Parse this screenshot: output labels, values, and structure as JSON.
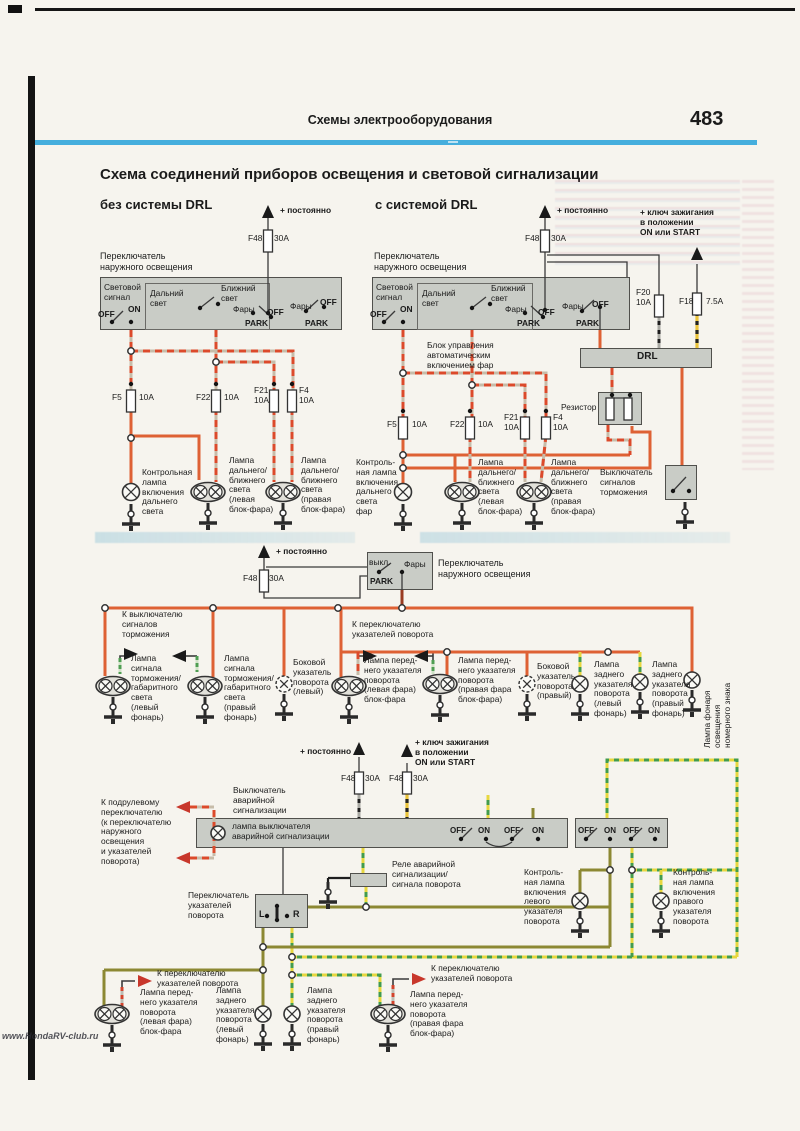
{
  "page": {
    "header": "Схемы  электрооборудования",
    "page_number": "483",
    "title": "Схема соединений приборов освещения и световой сигнализации",
    "left_subtitle": "без системы DRL",
    "right_subtitle": "с системой DRL",
    "watermark": "www.HondaRV-club.ru"
  },
  "colors": {
    "rule_blue": "#45aedd",
    "wire_orange": "#de6134",
    "wire_red_stripe": "#dc4a2b",
    "wire_yellow": "#eac33a",
    "wire_green": "#439c4c",
    "wire_olive": "#8c8833",
    "box_gray": "#c9ccc6"
  },
  "labels": [
    {
      "t": "+ постоянно",
      "x": 280,
      "y": 206,
      "fw": 700
    },
    {
      "t": "Переключатель\nнаружного освещения",
      "x": 100,
      "y": 251,
      "fs": 9
    },
    {
      "t": "Световой\nсигнал",
      "x": 104,
      "y": 283
    },
    {
      "t": "OFF",
      "x": 98,
      "y": 310,
      "fw": 600
    },
    {
      "t": "ON",
      "x": 128,
      "y": 305,
      "fw": 600
    },
    {
      "t": "Дальний\nсвет",
      "x": 150,
      "y": 289
    },
    {
      "t": "Ближний\nсвет",
      "x": 221,
      "y": 284
    },
    {
      "t": "Фары",
      "x": 233,
      "y": 305
    },
    {
      "t": "PARK",
      "x": 245,
      "y": 319,
      "fw": 600
    },
    {
      "t": "OFF",
      "x": 267,
      "y": 308,
      "fw": 600
    },
    {
      "t": "Фары",
      "x": 290,
      "y": 302
    },
    {
      "t": "OFF",
      "x": 320,
      "y": 298,
      "fw": 600
    },
    {
      "t": "PARK",
      "x": 305,
      "y": 319,
      "fw": 600
    },
    {
      "t": "F48",
      "x": 248,
      "y": 234
    },
    {
      "t": "30A",
      "x": 274,
      "y": 234
    },
    {
      "t": "F5",
      "x": 112,
      "y": 393
    },
    {
      "t": "10A",
      "x": 139,
      "y": 393
    },
    {
      "t": "F22",
      "x": 196,
      "y": 393
    },
    {
      "t": "10A",
      "x": 224,
      "y": 393
    },
    {
      "t": "F21\n10A",
      "x": 254,
      "y": 386
    },
    {
      "t": "F4\n10A",
      "x": 299,
      "y": 386
    },
    {
      "t": "Контрольная\nлампа\nвключения\nдальнего\nсвета",
      "x": 142,
      "y": 468
    },
    {
      "t": "Лампа\nдальнего/\nближнего\nсвета\n(левая\nблок-фара)",
      "x": 229,
      "y": 456
    },
    {
      "t": "Лампа\nдальнего/\nближнего\nсвета\n(правая\nблок-фара)",
      "x": 301,
      "y": 456
    },
    {
      "t": "+ постоянно",
      "x": 557,
      "y": 206,
      "fw": 700
    },
    {
      "t": "+ ключ зажигания\nв положении\nON или START",
      "x": 640,
      "y": 208,
      "fw": 700
    },
    {
      "t": "Переключатель\nнаружного освещения",
      "x": 374,
      "y": 251,
      "fs": 9
    },
    {
      "t": "Световой\nсигнал",
      "x": 376,
      "y": 283
    },
    {
      "t": "OFF",
      "x": 370,
      "y": 310,
      "fw": 600
    },
    {
      "t": "ON",
      "x": 400,
      "y": 305,
      "fw": 600
    },
    {
      "t": "Дальний\nсвет",
      "x": 422,
      "y": 289
    },
    {
      "t": "Ближний\nсвет",
      "x": 491,
      "y": 284
    },
    {
      "t": "Фары",
      "x": 505,
      "y": 305
    },
    {
      "t": "PARK",
      "x": 517,
      "y": 319,
      "fw": 600
    },
    {
      "t": "OFF",
      "x": 538,
      "y": 308,
      "fw": 600
    },
    {
      "t": "Фары",
      "x": 562,
      "y": 302
    },
    {
      "t": "PARK",
      "x": 576,
      "y": 319,
      "fw": 600
    },
    {
      "t": "OFF",
      "x": 592,
      "y": 300,
      "fw": 600
    },
    {
      "t": "F48",
      "x": 525,
      "y": 234
    },
    {
      "t": "30A",
      "x": 551,
      "y": 234
    },
    {
      "t": "F20\n10A",
      "x": 636,
      "y": 288
    },
    {
      "t": "F18",
      "x": 679,
      "y": 297
    },
    {
      "t": "7.5A",
      "x": 706,
      "y": 297
    },
    {
      "t": "Блок управления\nавтоматическим\nвключением фар",
      "x": 427,
      "y": 341
    },
    {
      "t": "DRL",
      "x": 637,
      "y": 351,
      "fs": 10,
      "fw": 600
    },
    {
      "t": "Резистор",
      "x": 561,
      "y": 403
    },
    {
      "t": "F5",
      "x": 387,
      "y": 420
    },
    {
      "t": "10A",
      "x": 412,
      "y": 420
    },
    {
      "t": "F22",
      "x": 450,
      "y": 420
    },
    {
      "t": "10A",
      "x": 478,
      "y": 420
    },
    {
      "t": "F21\n10A",
      "x": 504,
      "y": 413
    },
    {
      "t": "F4\n10A",
      "x": 553,
      "y": 413
    },
    {
      "t": "Контроль-\nная лампа\nвключения\nдальнего\nсвета\nфар",
      "x": 356,
      "y": 458
    },
    {
      "t": "Лампа\nдальнего/\nближнего\nсвета\n(левая\nблок-фара)",
      "x": 478,
      "y": 458
    },
    {
      "t": "Лампа\nдальнего/\nближнего\nсвета\n(правая\nблок-фара)",
      "x": 551,
      "y": 458
    },
    {
      "t": "Выключатель\nсигналов\nторможения",
      "x": 600,
      "y": 468
    },
    {
      "t": "+ постоянно",
      "x": 276,
      "y": 547,
      "fw": 700
    },
    {
      "t": "F48",
      "x": 243,
      "y": 574
    },
    {
      "t": "30A",
      "x": 269,
      "y": 574
    },
    {
      "t": "выкл.",
      "x": 369,
      "y": 558
    },
    {
      "t": "Фары",
      "x": 404,
      "y": 560
    },
    {
      "t": "PARK",
      "x": 370,
      "y": 577,
      "fw": 600
    },
    {
      "t": "Переключатель\nнаружного освещения",
      "x": 438,
      "y": 558,
      "fs": 9
    },
    {
      "t": "К выключателю\nсигналов\nторможения",
      "x": 122,
      "y": 610
    },
    {
      "t": "К переключателю\nуказателей поворота",
      "x": 352,
      "y": 620
    },
    {
      "t": "Лампа\nсигнала\nторможения/\nгабаритного\nсвета\n(левый\nфонарь)",
      "x": 131,
      "y": 654
    },
    {
      "t": "Лампа\nсигнала\nторможения/\nгабаритного\nсвета\n(правый\nфонарь)",
      "x": 224,
      "y": 654
    },
    {
      "t": "Боковой\nуказатель\nповорота\n(левый)",
      "x": 293,
      "y": 658
    },
    {
      "t": "Лампа перед-\nнего указателя\nповорота\n(левая фара)\nблок-фара",
      "x": 364,
      "y": 656
    },
    {
      "t": "Лампа перед-\nнего указателя\nповорота\n(правая фара\nблок-фара)",
      "x": 458,
      "y": 656
    },
    {
      "t": "Боковой\nуказатель\nповорота\n(правый)",
      "x": 537,
      "y": 662
    },
    {
      "t": "Лампа\nзаднего\nуказателя\nповорота\n(левый\nфонарь)",
      "x": 594,
      "y": 660
    },
    {
      "t": "Лампа\nзаднего\nуказателя\nповорота\n(правый\nфонарь)",
      "x": 652,
      "y": 660
    },
    {
      "t": "Лампа фонаря освещения\nномерного знака",
      "x": 703,
      "y": 748,
      "rot": -90
    },
    {
      "t": "+ постоянно",
      "x": 300,
      "y": 747,
      "fw": 700
    },
    {
      "t": "+ ключ зажигания\nв положении\nON или START",
      "x": 415,
      "y": 738,
      "fw": 700
    },
    {
      "t": "F48",
      "x": 341,
      "y": 774
    },
    {
      "t": "30A",
      "x": 365,
      "y": 774
    },
    {
      "t": "F48",
      "x": 389,
      "y": 774
    },
    {
      "t": "30A",
      "x": 413,
      "y": 774
    },
    {
      "t": "Выключатель\nаварийной\nсигнализации",
      "x": 233,
      "y": 786
    },
    {
      "t": "К подрулевому\nпереключателю\n(к переключателю\nнаружного\nосвещения\nи указателей\nповорота)",
      "x": 101,
      "y": 798
    },
    {
      "t": "лампа выключателя\nаварийной сигнализации",
      "x": 232,
      "y": 822
    },
    {
      "t": "OFF",
      "x": 450,
      "y": 826,
      "fs": 8,
      "fw": 600
    },
    {
      "t": "ON",
      "x": 478,
      "y": 826,
      "fs": 8,
      "fw": 600
    },
    {
      "t": "OFF",
      "x": 504,
      "y": 826,
      "fs": 8,
      "fw": 600
    },
    {
      "t": "ON",
      "x": 532,
      "y": 826,
      "fs": 8,
      "fw": 600
    },
    {
      "t": "OFF",
      "x": 578,
      "y": 826,
      "fs": 8,
      "fw": 600
    },
    {
      "t": "ON",
      "x": 604,
      "y": 826,
      "fs": 8,
      "fw": 600
    },
    {
      "t": "OFF",
      "x": 623,
      "y": 826,
      "fs": 8,
      "fw": 600
    },
    {
      "t": "ON",
      "x": 648,
      "y": 826,
      "fs": 8,
      "fw": 600
    },
    {
      "t": "Реле аварийной\nсигнализации/\nсигнала поворота",
      "x": 392,
      "y": 860
    },
    {
      "t": "Переключатель\nуказателей\nповорота",
      "x": 188,
      "y": 891
    },
    {
      "t": "L",
      "x": 259,
      "y": 909,
      "fs": 9,
      "fw": 600
    },
    {
      "t": "R",
      "x": 293,
      "y": 909,
      "fs": 9,
      "fw": 600
    },
    {
      "t": "Контроль-\nная лампа\nвключения\nлевого\nуказателя\nповорота",
      "x": 524,
      "y": 868
    },
    {
      "t": "Контроль-\nная лампа\nвключения\nправого\nуказателя\nповорота",
      "x": 673,
      "y": 868
    },
    {
      "t": "К переключателю\nуказателей поворота",
      "x": 157,
      "y": 969
    },
    {
      "t": "К переключателю\nуказателей поворота",
      "x": 431,
      "y": 964
    },
    {
      "t": "Лампа перед-\nнего указателя\nповорота\n(левая фара)\nблок-фара",
      "x": 140,
      "y": 988
    },
    {
      "t": "Лампа\nзаднего\nуказателя\nповорота\n(левый\nфонарь)",
      "x": 216,
      "y": 986
    },
    {
      "t": "Лампа\nзаднего\nуказателя\nповорота\n(правый\nфонарь)",
      "x": 307,
      "y": 986
    },
    {
      "t": "Лампа перед-\nнего указателя\nповорота\n(правая фара\nблок-фара)",
      "x": 410,
      "y": 990
    }
  ],
  "fuses": [
    {
      "x": 268,
      "y": 230
    },
    {
      "x": 545,
      "y": 230
    },
    {
      "x": 659,
      "y": 295
    },
    {
      "x": 697,
      "y": 293
    },
    {
      "x": 131,
      "y": 390
    },
    {
      "x": 216,
      "y": 390
    },
    {
      "x": 274,
      "y": 390
    },
    {
      "x": 292,
      "y": 390
    },
    {
      "x": 403,
      "y": 417
    },
    {
      "x": 470,
      "y": 417
    },
    {
      "x": 525,
      "y": 417
    },
    {
      "x": 546,
      "y": 417
    },
    {
      "x": 264,
      "y": 570
    },
    {
      "x": 359,
      "y": 772
    },
    {
      "x": 407,
      "y": 772
    }
  ],
  "lamps": [
    {
      "type": "dual",
      "x": 208,
      "y": 492
    },
    {
      "type": "dual",
      "x": 283,
      "y": 492
    },
    {
      "type": "dual",
      "x": 462,
      "y": 492
    },
    {
      "type": "dual",
      "x": 534,
      "y": 492
    },
    {
      "type": "dual",
      "x": 113,
      "y": 686
    },
    {
      "type": "dual",
      "x": 205,
      "y": 686
    },
    {
      "type": "dual",
      "x": 349,
      "y": 686
    },
    {
      "type": "dual",
      "x": 440,
      "y": 684
    },
    {
      "type": "dual",
      "x": 112,
      "y": 1014
    },
    {
      "type": "dual",
      "x": 388,
      "y": 1014
    },
    {
      "type": "single",
      "x": 131,
      "y": 492,
      "r": 8.5
    },
    {
      "type": "single",
      "x": 403,
      "y": 492,
      "r": 8.5
    },
    {
      "type": "single",
      "x": 218,
      "y": 833,
      "r": 7
    },
    {
      "type": "single",
      "x": 580,
      "y": 901,
      "r": 8
    },
    {
      "type": "single",
      "x": 661,
      "y": 901,
      "r": 8
    },
    {
      "type": "single",
      "x": 580,
      "y": 684,
      "r": 8
    },
    {
      "type": "single",
      "x": 640,
      "y": 682,
      "r": 8
    },
    {
      "type": "single",
      "x": 692,
      "y": 680,
      "r": 8
    },
    {
      "type": "single",
      "x": 263,
      "y": 1014,
      "r": 8
    },
    {
      "type": "single",
      "x": 292,
      "y": 1014,
      "r": 8
    },
    {
      "type": "side",
      "x": 284,
      "y": 684
    },
    {
      "type": "side",
      "x": 527,
      "y": 684
    }
  ],
  "grounds": [
    {
      "x": 131,
      "y": 504
    },
    {
      "x": 208,
      "y": 503
    },
    {
      "x": 283,
      "y": 503
    },
    {
      "x": 403,
      "y": 504
    },
    {
      "x": 462,
      "y": 503
    },
    {
      "x": 534,
      "y": 503
    },
    {
      "x": 685,
      "y": 502
    },
    {
      "x": 113,
      "y": 697
    },
    {
      "x": 205,
      "y": 697
    },
    {
      "x": 284,
      "y": 694
    },
    {
      "x": 349,
      "y": 697
    },
    {
      "x": 440,
      "y": 695
    },
    {
      "x": 527,
      "y": 694
    },
    {
      "x": 580,
      "y": 694
    },
    {
      "x": 640,
      "y": 692
    },
    {
      "x": 692,
      "y": 690
    },
    {
      "x": 328,
      "y": 882
    },
    {
      "x": 580,
      "y": 911
    },
    {
      "x": 661,
      "y": 911
    },
    {
      "x": 112,
      "y": 1025
    },
    {
      "x": 263,
      "y": 1024
    },
    {
      "x": 292,
      "y": 1024
    },
    {
      "x": 388,
      "y": 1025
    }
  ],
  "junctions": [
    {
      "x": 131,
      "y": 351
    },
    {
      "x": 216,
      "y": 362
    },
    {
      "x": 131,
      "y": 438
    },
    {
      "x": 403,
      "y": 373
    },
    {
      "x": 472,
      "y": 385
    },
    {
      "x": 403,
      "y": 455
    },
    {
      "x": 403,
      "y": 468
    },
    {
      "x": 105,
      "y": 608
    },
    {
      "x": 213,
      "y": 608
    },
    {
      "x": 338,
      "y": 608
    },
    {
      "x": 402,
      "y": 608
    },
    {
      "x": 447,
      "y": 652
    },
    {
      "x": 608,
      "y": 652
    },
    {
      "x": 263,
      "y": 947
    },
    {
      "x": 292,
      "y": 957
    },
    {
      "x": 610,
      "y": 870
    },
    {
      "x": 632,
      "y": 870
    },
    {
      "x": 366,
      "y": 907
    },
    {
      "x": 263,
      "y": 970
    },
    {
      "x": 292,
      "y": 975
    }
  ],
  "dots": [
    {
      "x": 131,
      "y": 384
    },
    {
      "x": 216,
      "y": 384
    },
    {
      "x": 274,
      "y": 384
    },
    {
      "x": 292,
      "y": 384
    },
    {
      "x": 403,
      "y": 411
    },
    {
      "x": 470,
      "y": 411
    },
    {
      "x": 525,
      "y": 411
    },
    {
      "x": 546,
      "y": 411
    },
    {
      "x": 112,
      "y": 322
    },
    {
      "x": 131,
      "y": 322
    },
    {
      "x": 384,
      "y": 322
    },
    {
      "x": 403,
      "y": 322
    },
    {
      "x": 200,
      "y": 308
    },
    {
      "x": 218,
      "y": 304
    },
    {
      "x": 472,
      "y": 308
    },
    {
      "x": 490,
      "y": 304
    },
    {
      "x": 253,
      "y": 313
    },
    {
      "x": 271,
      "y": 317
    },
    {
      "x": 525,
      "y": 313
    },
    {
      "x": 543,
      "y": 317
    },
    {
      "x": 306,
      "y": 311
    },
    {
      "x": 324,
      "y": 307
    },
    {
      "x": 582,
      "y": 311
    },
    {
      "x": 600,
      "y": 307
    },
    {
      "x": 268,
      "y": 313
    },
    {
      "x": 545,
      "y": 310
    },
    {
      "x": 379,
      "y": 572
    },
    {
      "x": 402,
      "y": 572
    },
    {
      "x": 673,
      "y": 491
    },
    {
      "x": 689,
      "y": 491
    },
    {
      "x": 267,
      "y": 916
    },
    {
      "x": 287,
      "y": 916
    },
    {
      "x": 277,
      "y": 906
    },
    {
      "x": 277,
      "y": 920
    },
    {
      "x": 461,
      "y": 839
    },
    {
      "x": 486,
      "y": 839
    },
    {
      "x": 512,
      "y": 839
    },
    {
      "x": 538,
      "y": 839
    },
    {
      "x": 586,
      "y": 839
    },
    {
      "x": 610,
      "y": 839
    },
    {
      "x": 631,
      "y": 839
    },
    {
      "x": 655,
      "y": 839
    },
    {
      "x": 612,
      "y": 395
    },
    {
      "x": 630,
      "y": 395
    }
  ],
  "arrows": [
    {
      "x": 268,
      "y": 205,
      "dir": "up",
      "c": "black"
    },
    {
      "x": 545,
      "y": 205,
      "dir": "up",
      "c": "black"
    },
    {
      "x": 697,
      "y": 247,
      "dir": "up",
      "c": "black"
    },
    {
      "x": 264,
      "y": 545,
      "dir": "up",
      "c": "black"
    },
    {
      "x": 359,
      "y": 742,
      "dir": "up",
      "c": "black"
    },
    {
      "x": 407,
      "y": 744,
      "dir": "up",
      "c": "black"
    },
    {
      "x": 138,
      "y": 654,
      "dir": "right",
      "c": "black"
    },
    {
      "x": 172,
      "y": 656,
      "dir": "left",
      "c": "black"
    },
    {
      "x": 377,
      "y": 656,
      "dir": "right",
      "c": "black"
    },
    {
      "x": 414,
      "y": 656,
      "dir": "left",
      "c": "black"
    },
    {
      "x": 176,
      "y": 807,
      "dir": "left",
      "c": "red"
    },
    {
      "x": 176,
      "y": 858,
      "dir": "left",
      "c": "red"
    },
    {
      "x": 152,
      "y": 981,
      "dir": "right",
      "c": "red"
    },
    {
      "x": 426,
      "y": 979,
      "dir": "right",
      "c": "red"
    }
  ]
}
